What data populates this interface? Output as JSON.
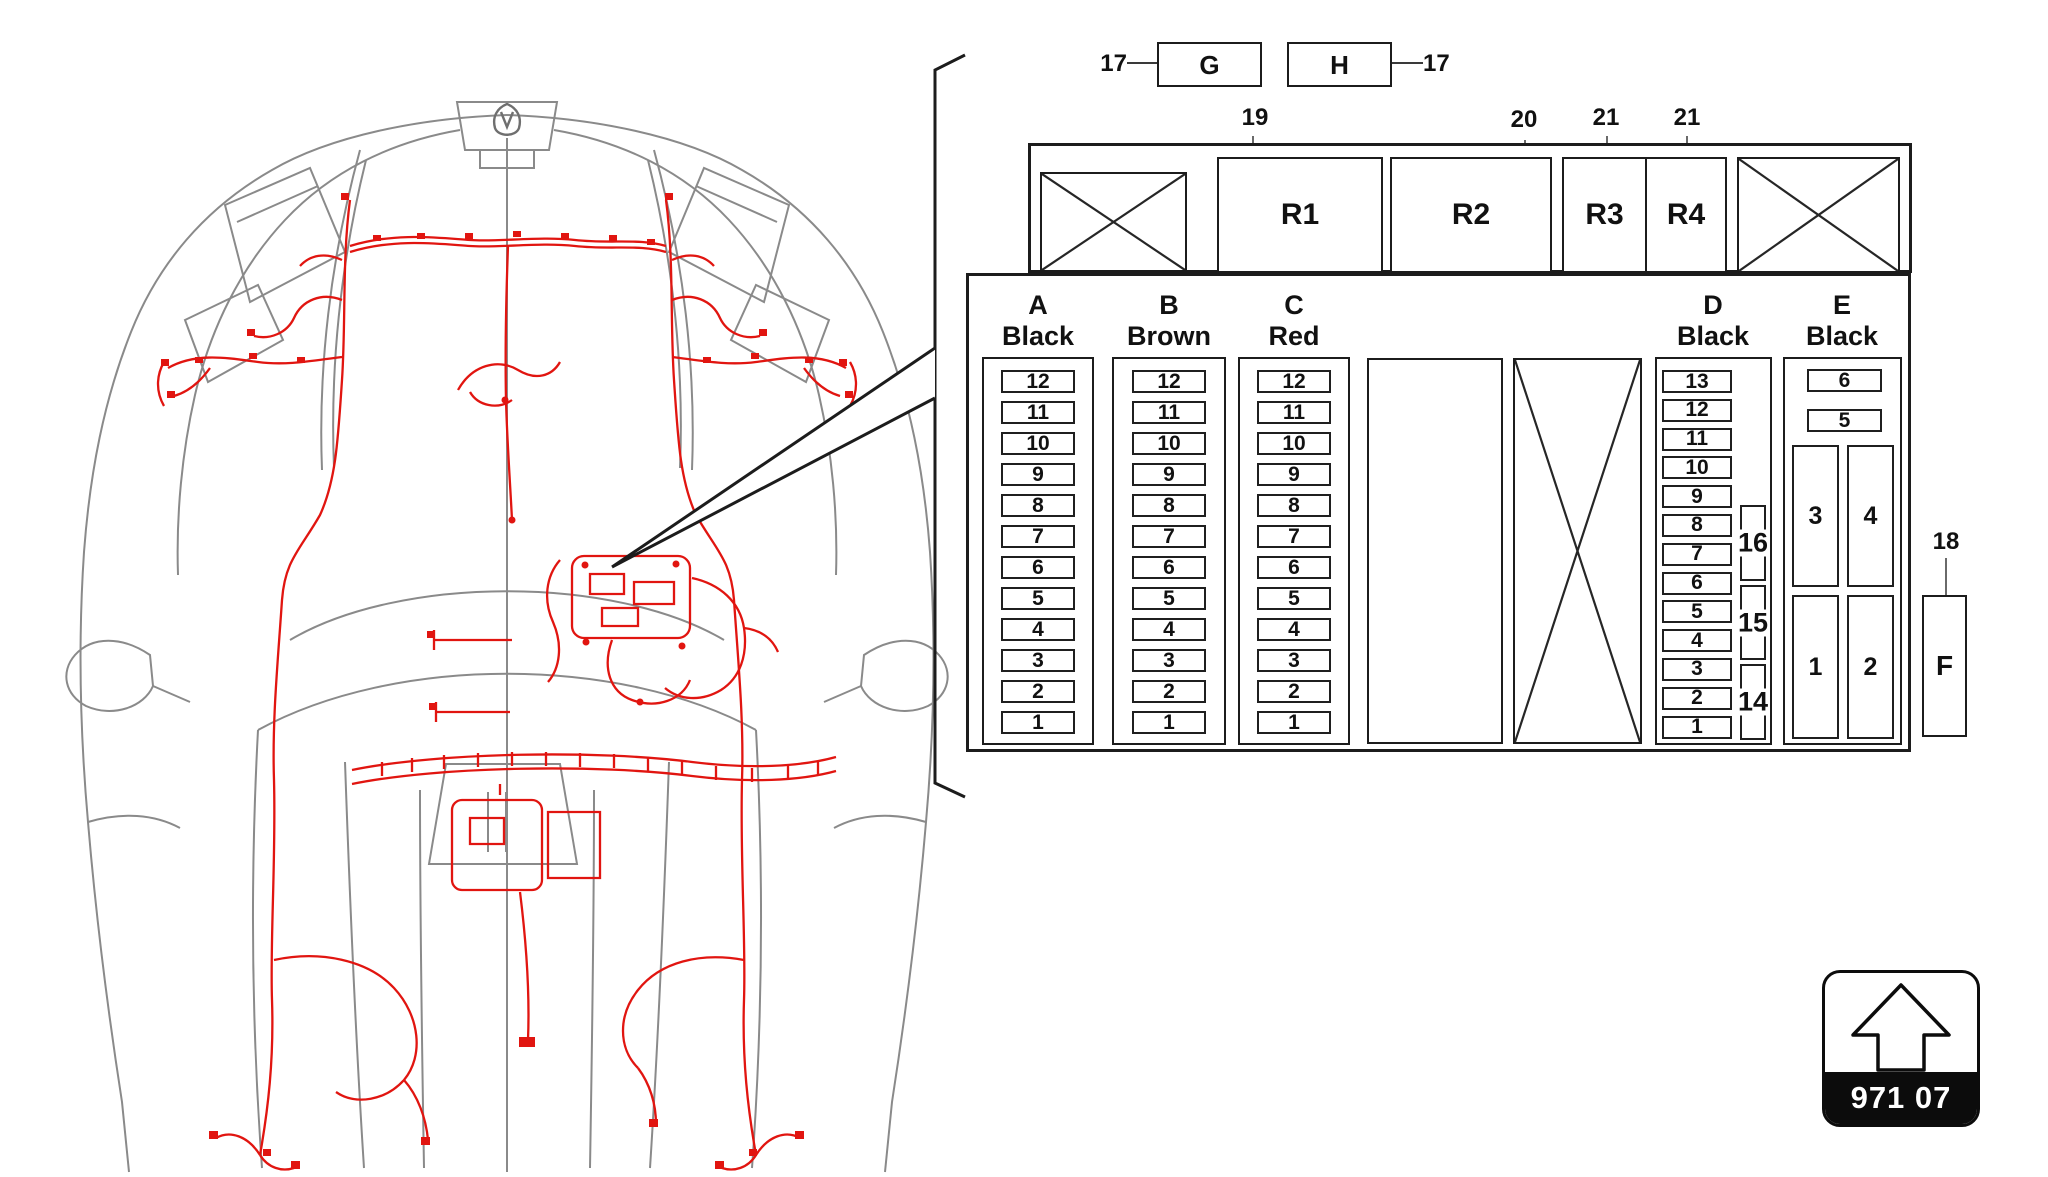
{
  "colors": {
    "line": "#1c1c1c",
    "car_outline_gray": "#8a8a8a",
    "harness_red": "#e11510",
    "badge_bg": "#0c0c0c",
    "badge_text": "#ffffff"
  },
  "callouts": {
    "g_label": "G",
    "h_label": "H",
    "g_pointer": "17",
    "h_pointer": "17"
  },
  "relay_row": {
    "r1": {
      "label": "R1",
      "pointer": "19"
    },
    "r2": {
      "label": "R2",
      "pointer": "20"
    },
    "r3": {
      "label": "R3",
      "pointer": "21"
    },
    "r4": {
      "label": "R4",
      "pointer": "21"
    }
  },
  "fuse_panel": {
    "columns": [
      {
        "letter": "A",
        "color_name": "Black",
        "fuses": [
          "12",
          "11",
          "10",
          "9",
          "8",
          "7",
          "6",
          "5",
          "4",
          "3",
          "2",
          "1"
        ]
      },
      {
        "letter": "B",
        "color_name": "Brown",
        "fuses": [
          "12",
          "11",
          "10",
          "9",
          "8",
          "7",
          "6",
          "5",
          "4",
          "3",
          "2",
          "1"
        ]
      },
      {
        "letter": "C",
        "color_name": "Red",
        "fuses": [
          "12",
          "11",
          "10",
          "9",
          "8",
          "7",
          "6",
          "5",
          "4",
          "3",
          "2",
          "1"
        ]
      },
      {
        "letter": "D",
        "color_name": "Black",
        "fuses": [
          "13",
          "12",
          "11",
          "10",
          "9",
          "8",
          "7",
          "6",
          "5",
          "4",
          "3",
          "2",
          "1"
        ],
        "side_slots": [
          "16",
          "15",
          "14"
        ]
      },
      {
        "letter": "E",
        "color_name": "Black",
        "mini_fuses": [
          "6",
          "5"
        ],
        "relay_slots": [
          "3",
          "4",
          "1",
          "2"
        ]
      }
    ],
    "external_slot": {
      "label": "F",
      "pointer": "18"
    }
  },
  "badge": {
    "code": "971 07",
    "icon": "up-arrow"
  }
}
